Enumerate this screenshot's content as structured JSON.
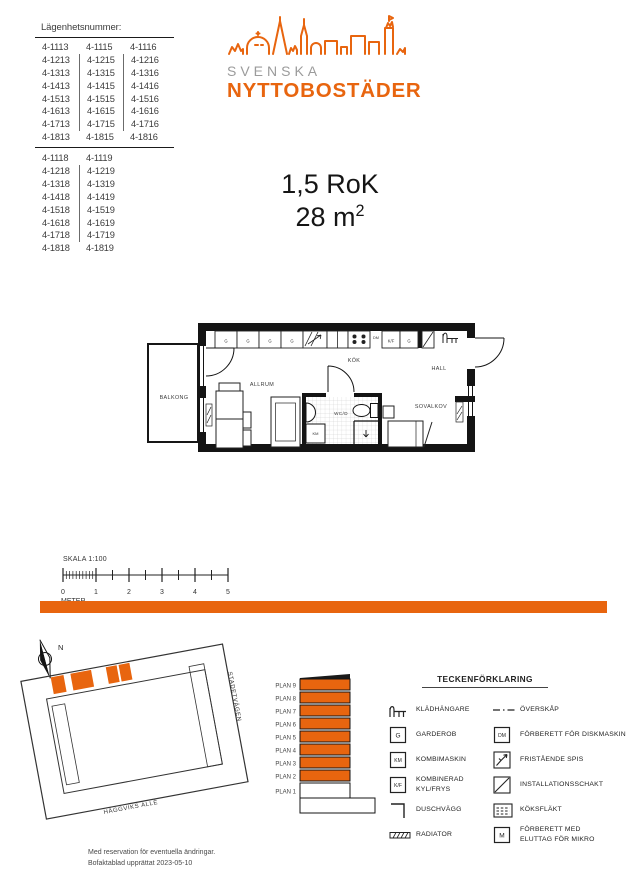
{
  "palette": {
    "orange": "#e8650f",
    "logo_gray": "#9b9b9b",
    "line_black": "#141414"
  },
  "apartment_table": {
    "title": "Lägenhetsnummer:",
    "group1_rows": [
      [
        "4-1113",
        "4-1115",
        "4-1116"
      ],
      [
        "4-1213",
        "4-1215",
        "4-1216"
      ],
      [
        "4-1313",
        "4-1315",
        "4-1316"
      ],
      [
        "4-1413",
        "4-1415",
        "4-1416"
      ],
      [
        "4-1513",
        "4-1515",
        "4-1516"
      ],
      [
        "4-1613",
        "4-1615",
        "4-1616"
      ],
      [
        "4-1713",
        "4-1715",
        "4-1716"
      ],
      [
        "4-1813",
        "4-1815",
        "4-1816"
      ]
    ],
    "group2_rows": [
      [
        "4-1118",
        "4-1119"
      ],
      [
        "4-1218",
        "4-1219"
      ],
      [
        "4-1318",
        "4-1319"
      ],
      [
        "4-1418",
        "4-1419"
      ],
      [
        "4-1518",
        "4-1519"
      ],
      [
        "4-1618",
        "4-1619"
      ],
      [
        "4-1718",
        "4-1719"
      ],
      [
        "4-1818",
        "4-1819"
      ]
    ]
  },
  "logo": {
    "line1": "SVENSKA",
    "line2": "NYTTOBOSTÄDER"
  },
  "apartment_info": {
    "rok": "1,5 RoK",
    "area_base": "28 m",
    "area_sup": "2"
  },
  "floorplan": {
    "balkong": "BALKONG",
    "allrum": "ALLRUM",
    "kok": "KÖK",
    "hall": "HALL",
    "sovalkov": "SOVALKOV",
    "wcd": "WC/D",
    "garderob": "G",
    "km": "KM",
    "kf": "K/F",
    "dm": "DM"
  },
  "scale": {
    "label": "SKALA 1:100",
    "unit": "METER",
    "ticks": [
      "0",
      "1",
      "2",
      "3",
      "4",
      "5"
    ]
  },
  "siteplan": {
    "north": "N",
    "street_side": "STADETVÄGEN",
    "street_bottom": "HÄGGVIKS ALLÉ"
  },
  "elevation": {
    "floors": [
      "PLAN 9",
      "PLAN 8",
      "PLAN 7",
      "PLAN 6",
      "PLAN 5",
      "PLAN 4",
      "PLAN 3",
      "PLAN 2",
      "PLAN 1"
    ]
  },
  "legend": {
    "title": "TECKENFÖRKLARING",
    "box_letters": {
      "box-g": "G",
      "box-km": "KM",
      "box-kf": "K/F",
      "box-dm": "DM",
      "box-m": "M"
    },
    "items_left": [
      {
        "symbol": "kladhangare",
        "label": "KLÄDHÄNGARE"
      },
      {
        "symbol": "box-g",
        "label": "GARDEROB"
      },
      {
        "symbol": "box-km",
        "label": "KOMBIMASKIN"
      },
      {
        "symbol": "box-kf",
        "label": "KOMBINERAD\nKYL/FRYS"
      },
      {
        "symbol": "duschvagg",
        "label": "DUSCHVÄGG"
      },
      {
        "symbol": "radiator",
        "label": "RADIATOR"
      }
    ],
    "items_right": [
      {
        "symbol": "overskap",
        "label": "ÖVERSKÅP"
      },
      {
        "symbol": "box-dm",
        "label": "FÖRBERETT FÖR DISKMASKIN"
      },
      {
        "symbol": "spis",
        "label": "FRISTÅENDE SPIS"
      },
      {
        "symbol": "schakt",
        "label": "INSTALLATIONSSCHAKT"
      },
      {
        "symbol": "koksflakt",
        "label": "KÖKSFLÄKT"
      },
      {
        "symbol": "box-m",
        "label": "FÖRBERETT MED\nELUTTAG FÖR MIKRO"
      }
    ]
  },
  "footer": {
    "line1": "Med reservation för eventuella ändringar.",
    "line2": "Bofaktablad upprättat 2023-05-10"
  }
}
